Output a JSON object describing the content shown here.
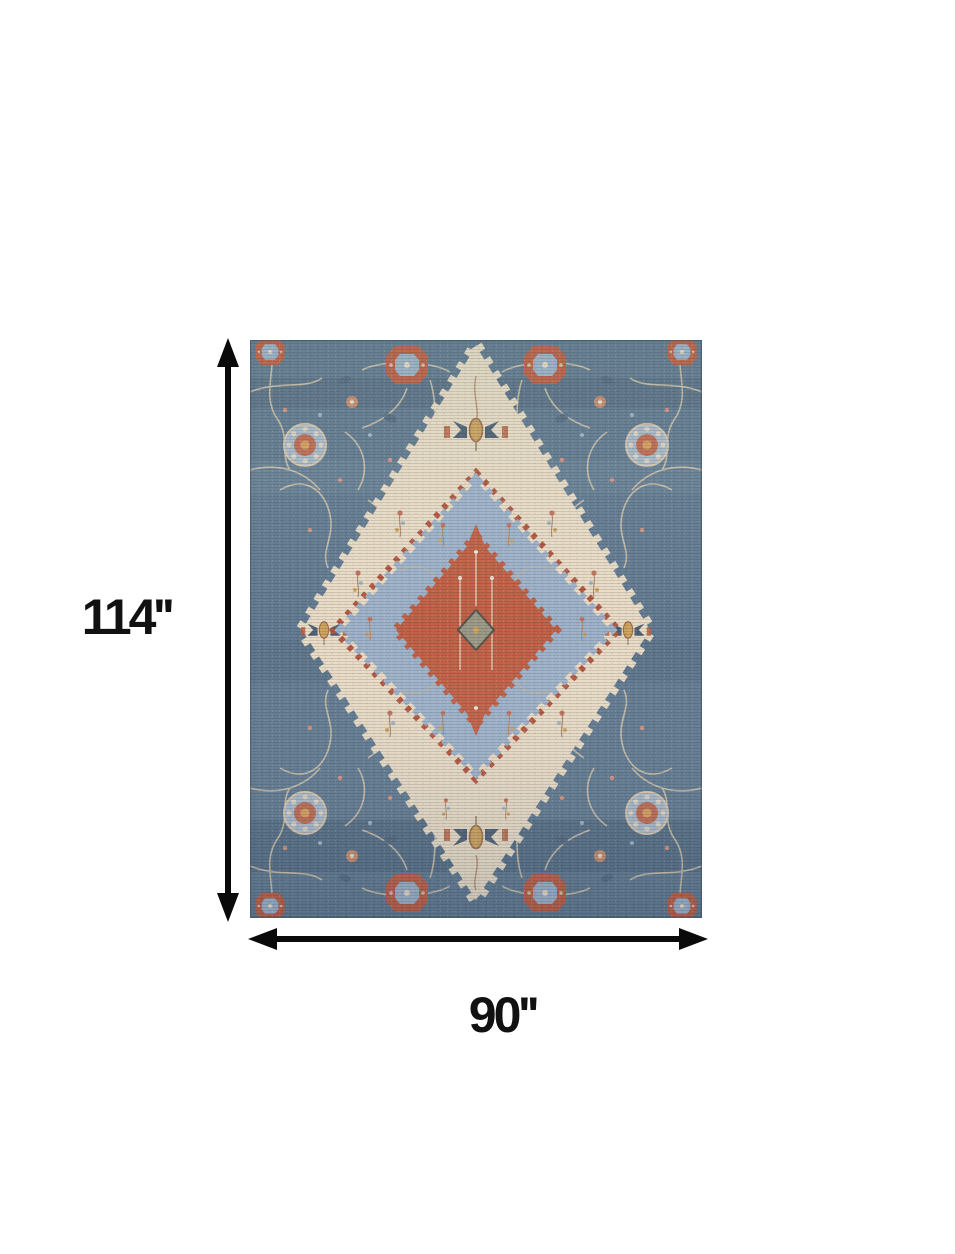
{
  "page": {
    "background": "#ffffff"
  },
  "dimensions": {
    "height_label": "114''",
    "width_label": "90''",
    "arrow_color": "#0a0a0a"
  },
  "rug": {
    "description": "Blue and ivory traditional medallion area rug",
    "colors": {
      "field_blue": "#61798f",
      "field_blue_dark": "#2f4257",
      "cream": "#e9dbc4",
      "inner_blue": "#9db1c8",
      "rust": "#c05e42",
      "rust_dark": "#b5543c",
      "gold": "#cda25a",
      "tan_outline": "#d8c7ab",
      "slate": "#4d5f70"
    }
  }
}
